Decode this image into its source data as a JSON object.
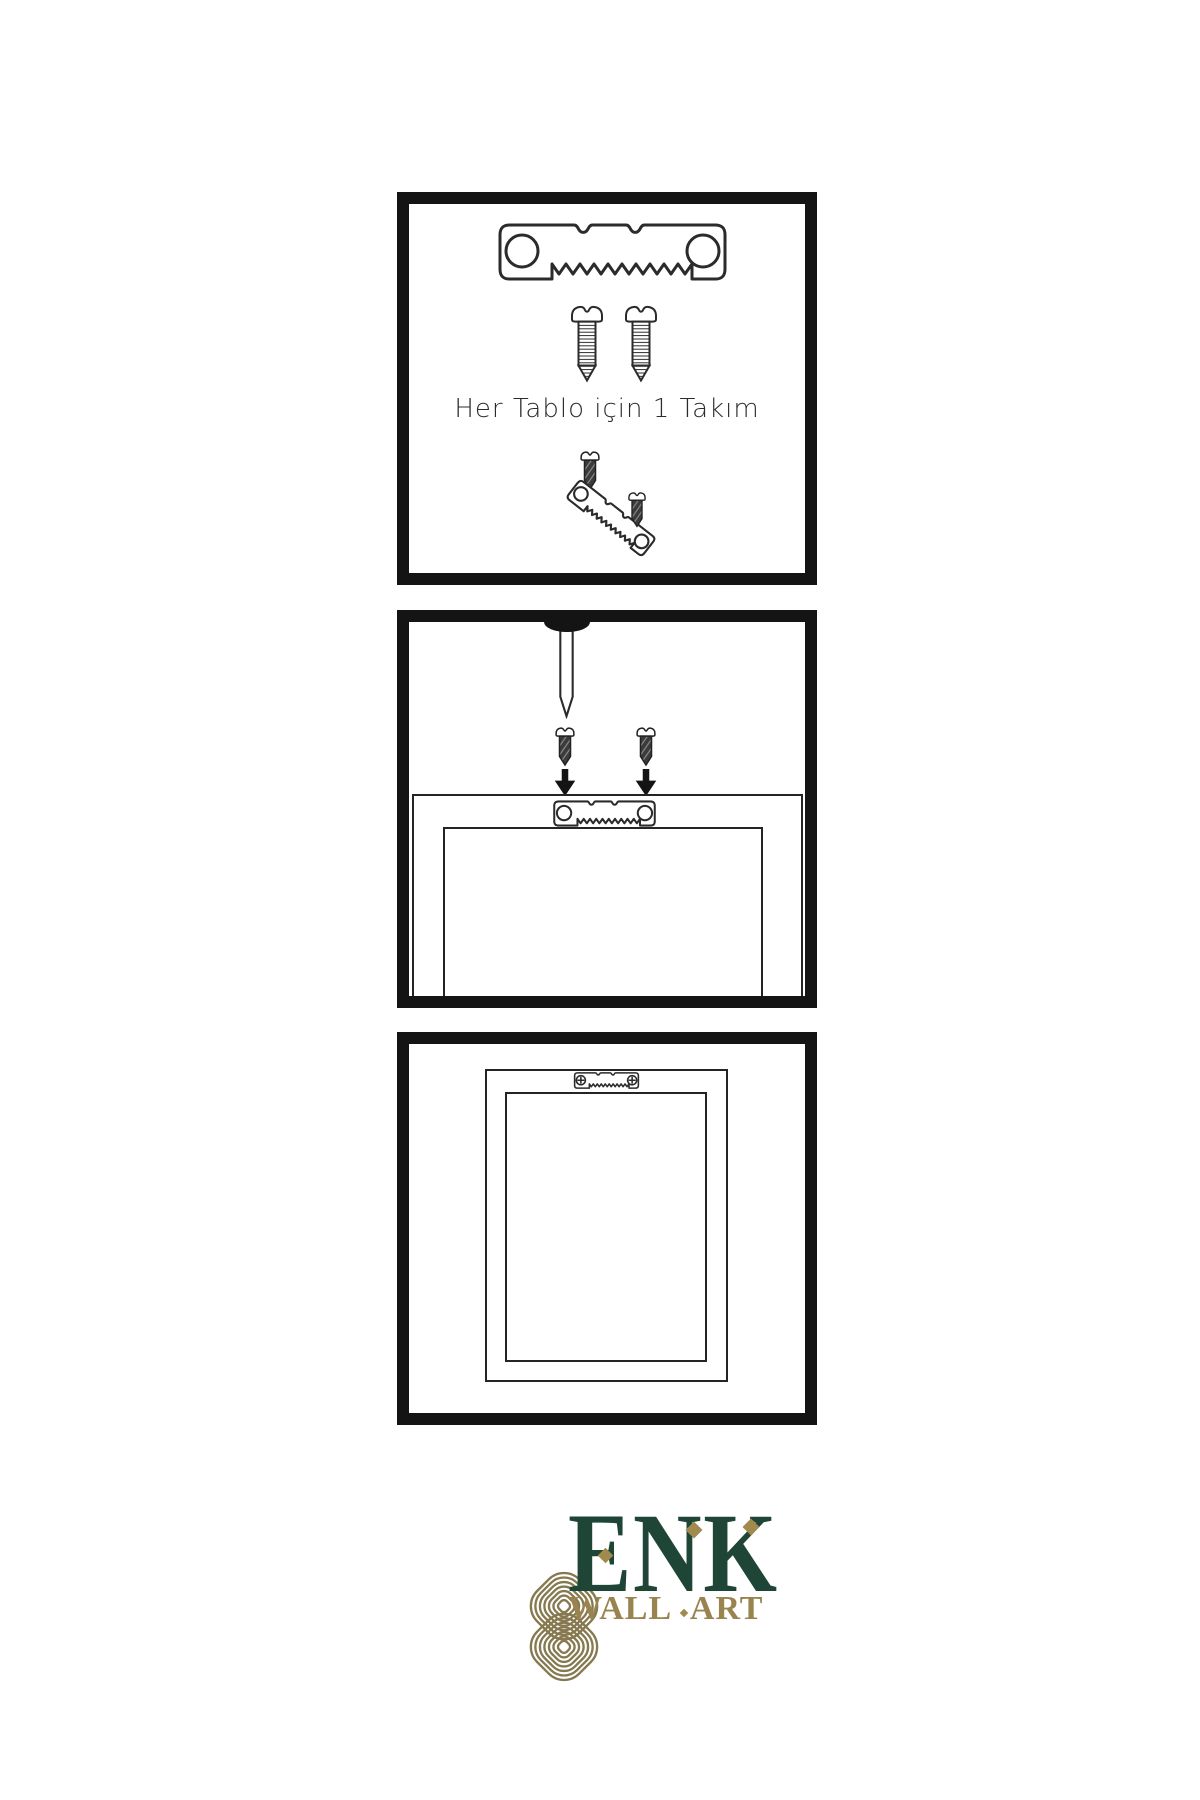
{
  "page": {
    "background": "#ffffff",
    "width": 1200,
    "height": 1800
  },
  "colors": {
    "ink": "#2b2b2b",
    "panel_border": "#141414",
    "screw_dark_fill": "#3b3b3b",
    "brand_green": "#1e4536",
    "brand_gold": "#86794f",
    "brand_gold_accent": "#a18a4d",
    "brand_gold_text": "#99844f"
  },
  "panel1": {
    "caption": "Her Tablo için 1 Takım"
  },
  "logo": {
    "title": "ENK",
    "subtitle": "WALL ART"
  },
  "icons": {
    "sawtooth_hanger": "sawtooth-hanger-icon",
    "sawtooth_hanger_screwed": "sawtooth-hanger-screwed-icon",
    "screw": "screw-icon",
    "dark_screw": "dark-screw-icon",
    "nail": "nail-icon",
    "arrow_down": "arrow-down-icon",
    "picture_frame": "picture-frame-icon",
    "knot_logo": "celtic-knot-logo-icon"
  }
}
